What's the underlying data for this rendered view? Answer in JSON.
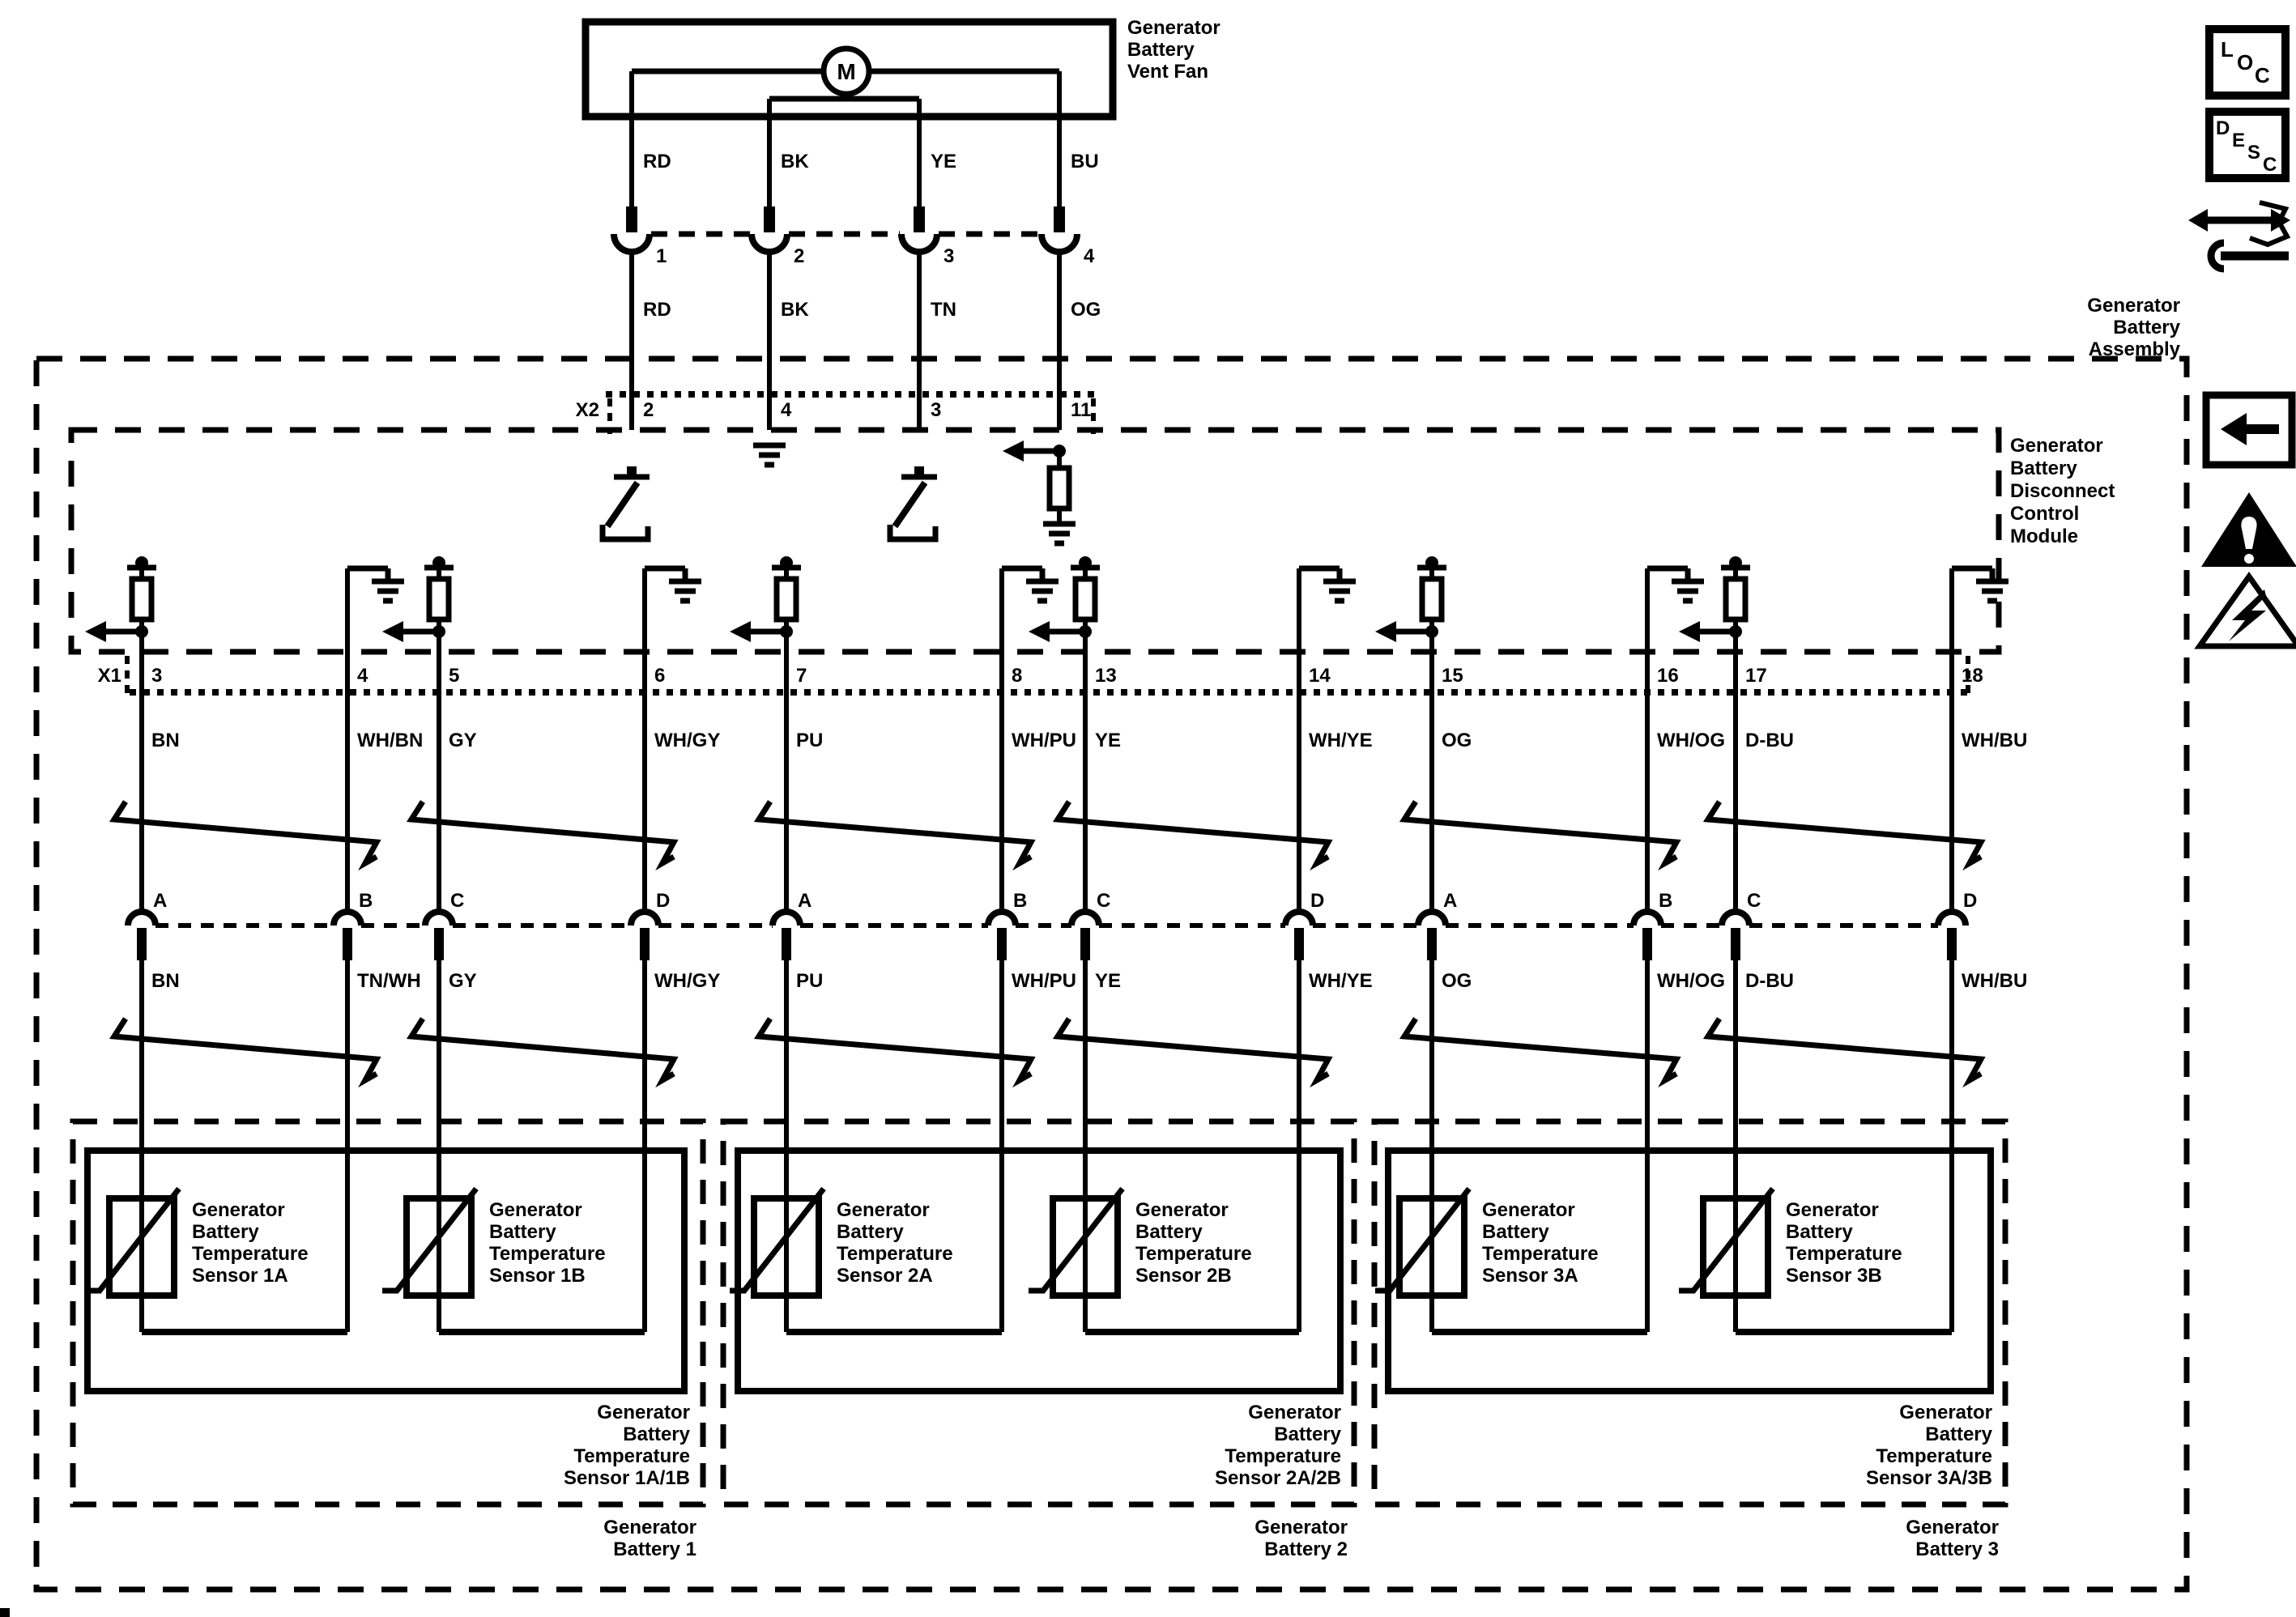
{
  "page": {
    "bg": "#ffffff",
    "ink": "#000000"
  },
  "fan": {
    "label_lines": [
      "Generator",
      "Battery",
      "Vent Fan"
    ],
    "motor": "M",
    "wires": [
      {
        "color": "RD",
        "pin": "1",
        "lower_color": "RD",
        "x2_pin": "2"
      },
      {
        "color": "BK",
        "pin": "2",
        "lower_color": "BK",
        "x2_pin": "4"
      },
      {
        "color": "YE",
        "pin": "3",
        "lower_color": "TN",
        "x2_pin": "3"
      },
      {
        "color": "BU",
        "pin": "4",
        "lower_color": "OG",
        "x2_pin": "11"
      }
    ]
  },
  "assembly": {
    "label_lines": [
      "Generator",
      "Battery",
      "Assembly"
    ]
  },
  "module": {
    "label_lines": [
      "Generator",
      "Battery",
      "Disconnect",
      "Control",
      "Module"
    ],
    "x2_label": "X2",
    "x1_label": "X1"
  },
  "x1_circuits": [
    {
      "pin": "3",
      "upper_color": "BN",
      "lower_color": "BN",
      "letter": "A",
      "kind": "signal"
    },
    {
      "pin": "4",
      "upper_color": "WH/BN",
      "lower_color": "TN/WH",
      "letter": "B",
      "kind": "ground"
    },
    {
      "pin": "5",
      "upper_color": "GY",
      "lower_color": "GY",
      "letter": "C",
      "kind": "signal"
    },
    {
      "pin": "6",
      "upper_color": "WH/GY",
      "lower_color": "WH/GY",
      "letter": "D",
      "kind": "ground"
    },
    {
      "pin": "7",
      "upper_color": "PU",
      "lower_color": "PU",
      "letter": "A",
      "kind": "signal"
    },
    {
      "pin": "8",
      "upper_color": "WH/PU",
      "lower_color": "WH/PU",
      "letter": "B",
      "kind": "ground"
    },
    {
      "pin": "13",
      "upper_color": "YE",
      "lower_color": "YE",
      "letter": "C",
      "kind": "signal"
    },
    {
      "pin": "14",
      "upper_color": "WH/YE",
      "lower_color": "WH/YE",
      "letter": "D",
      "kind": "ground"
    },
    {
      "pin": "15",
      "upper_color": "OG",
      "lower_color": "OG",
      "letter": "A",
      "kind": "signal"
    },
    {
      "pin": "16",
      "upper_color": "WH/OG",
      "lower_color": "WH/OG",
      "letter": "B",
      "kind": "ground"
    },
    {
      "pin": "17",
      "upper_color": "D-BU",
      "lower_color": "D-BU",
      "letter": "C",
      "kind": "signal"
    },
    {
      "pin": "18",
      "upper_color": "WH/BU",
      "lower_color": "WH/BU",
      "letter": "D",
      "kind": "ground"
    }
  ],
  "batteries": [
    {
      "name_lines": [
        "Generator",
        "Battery 1"
      ],
      "group_label_lines": [
        "Generator",
        "Battery",
        "Temperature",
        "Sensor 1A/1B"
      ],
      "sensors": [
        {
          "label_lines": [
            "Generator",
            "Battery",
            "Temperature",
            "Sensor 1A"
          ]
        },
        {
          "label_lines": [
            "Generator",
            "Battery",
            "Temperature",
            "Sensor 1B"
          ]
        }
      ]
    },
    {
      "name_lines": [
        "Generator",
        "Battery 2"
      ],
      "group_label_lines": [
        "Generator",
        "Battery",
        "Temperature",
        "Sensor 2A/2B"
      ],
      "sensors": [
        {
          "label_lines": [
            "Generator",
            "Battery",
            "Temperature",
            "Sensor 2A"
          ]
        },
        {
          "label_lines": [
            "Generator",
            "Battery",
            "Temperature",
            "Sensor 2B"
          ]
        }
      ]
    },
    {
      "name_lines": [
        "Generator",
        "Battery 3"
      ],
      "group_label_lines": [
        "Generator",
        "Battery",
        "Temperature",
        "Sensor 3A/3B"
      ],
      "sensors": [
        {
          "label_lines": [
            "Generator",
            "Battery",
            "Temperature",
            "Sensor 3A"
          ]
        },
        {
          "label_lines": [
            "Generator",
            "Battery",
            "Temperature",
            "Sensor 3B"
          ]
        }
      ]
    }
  ],
  "side_icons": {
    "loc": [
      "L",
      "O",
      "C"
    ],
    "desc": [
      "D",
      "E",
      "S",
      "C"
    ]
  }
}
